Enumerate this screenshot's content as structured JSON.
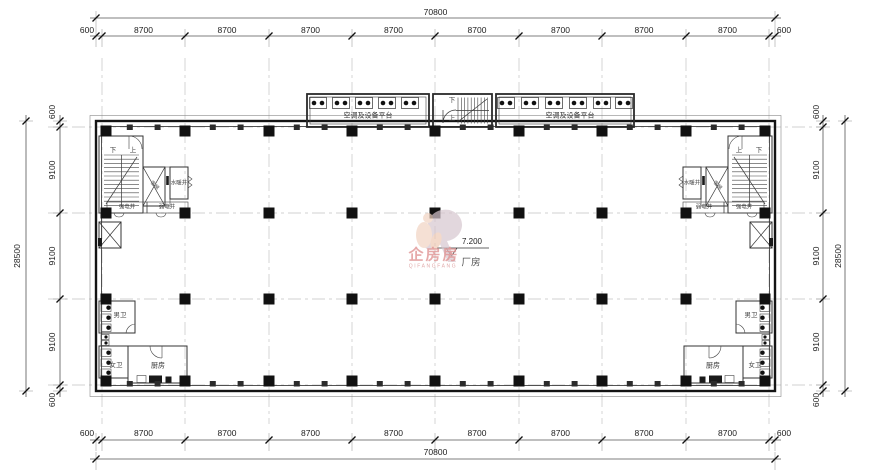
{
  "dims": {
    "top": {
      "total": "70800",
      "segments": [
        "600",
        "8700",
        "8700",
        "8700",
        "8700",
        "8700",
        "8700",
        "8700",
        "8700",
        "600"
      ]
    },
    "bottom": {
      "total": "70800",
      "segments": [
        "600",
        "8700",
        "8700",
        "8700",
        "8700",
        "8700",
        "8700",
        "8700",
        "8700",
        "600"
      ]
    },
    "left": {
      "total": "28500",
      "segments": [
        "600",
        "9100",
        "9100",
        "9100",
        "600"
      ]
    },
    "right": {
      "total": "28500",
      "segments": [
        "600",
        "9100",
        "9100",
        "9100",
        "600"
      ]
    }
  },
  "labels": {
    "platform": "空调及设备平台",
    "up": "上",
    "down": "下",
    "water_shaft": "水暖井",
    "strong_elec_shaft": "强电井",
    "weak_elec_shaft": "弱电井",
    "elevator": "客梯",
    "mens_wc": "男卫",
    "womens_wc": "女卫",
    "kitchen": "厨房",
    "hall": "厂房",
    "elevation": "7.200"
  },
  "watermark": {
    "text": "企房房",
    "subtext": "QIFANGFANG",
    "color": "#e09494"
  },
  "colors": {
    "line": "#1a1a1a",
    "grid": "#c2c2c2",
    "dim_text": "#1d1d1d",
    "watermark_pink": "#e09494",
    "figure_peach": "#f2d4c2"
  }
}
